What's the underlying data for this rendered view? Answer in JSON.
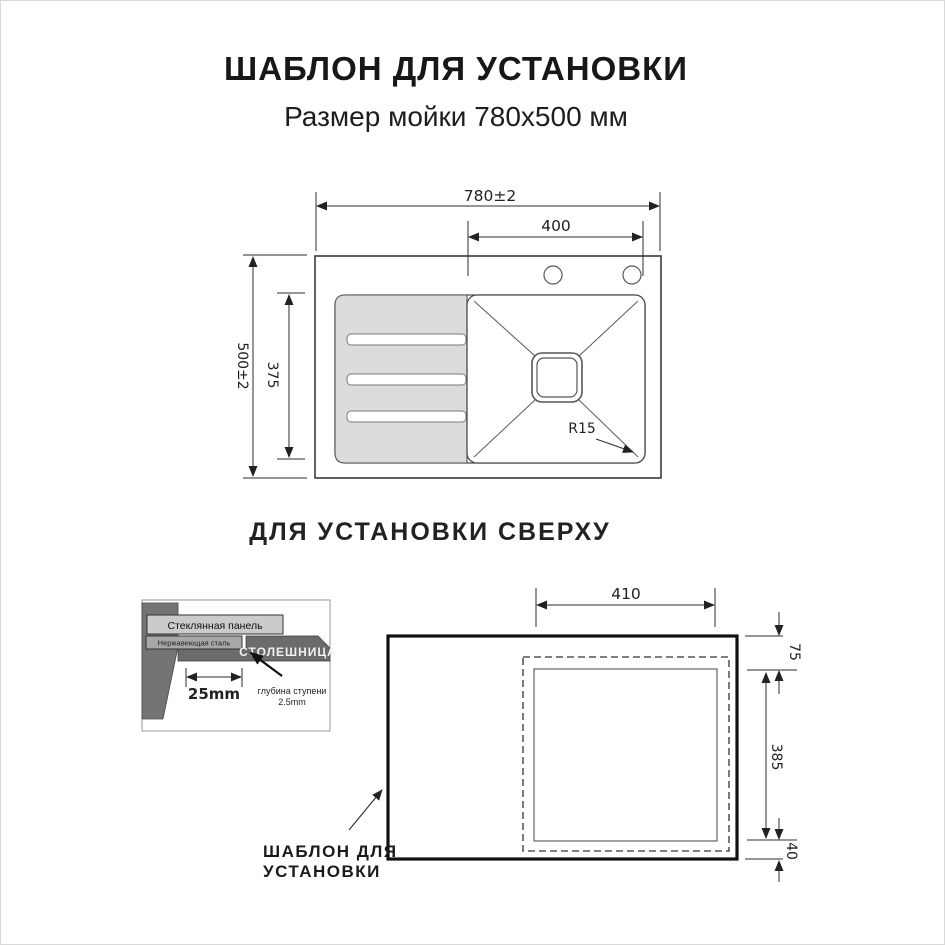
{
  "page": {
    "title": "ШАБЛОН ДЛЯ УСТАНОВКИ",
    "subtitle": "Размер мойки 780х500 мм",
    "section_label": "ДЛЯ УСТАНОВКИ СВЕРХУ"
  },
  "top_view": {
    "dim_overall_width": "780±2",
    "dim_bowl_width": "400",
    "dim_overall_height": "500±2",
    "dim_inner_height": "375",
    "corner_radius_label": "R15"
  },
  "section_detail": {
    "glass_panel_label": "Стеклянная панель",
    "steel_label": "Нержавеющая сталь",
    "countertop_label": "СТОЛЕШНИЦА",
    "step_width_label": "25mm",
    "step_depth_label_line1": "глубина ступени",
    "step_depth_label_line2": "2.5mm"
  },
  "template_view": {
    "dim_cutout_width": "410",
    "dim_top_offset": "75",
    "dim_cutout_height": "385",
    "dim_bottom_offset": "40",
    "label_line1": "ШАБЛОН ДЛЯ",
    "label_line2": "УСТАНОВКИ"
  },
  "colors": {
    "line": "#333333",
    "drainboard_fill": "#dcdcdc",
    "countertop_fill": "#6b6b6b",
    "wall_fill": "#747474",
    "glass_bar_fill": "#cbcbcb",
    "steel_bar_fill": "#a8a8a8"
  }
}
